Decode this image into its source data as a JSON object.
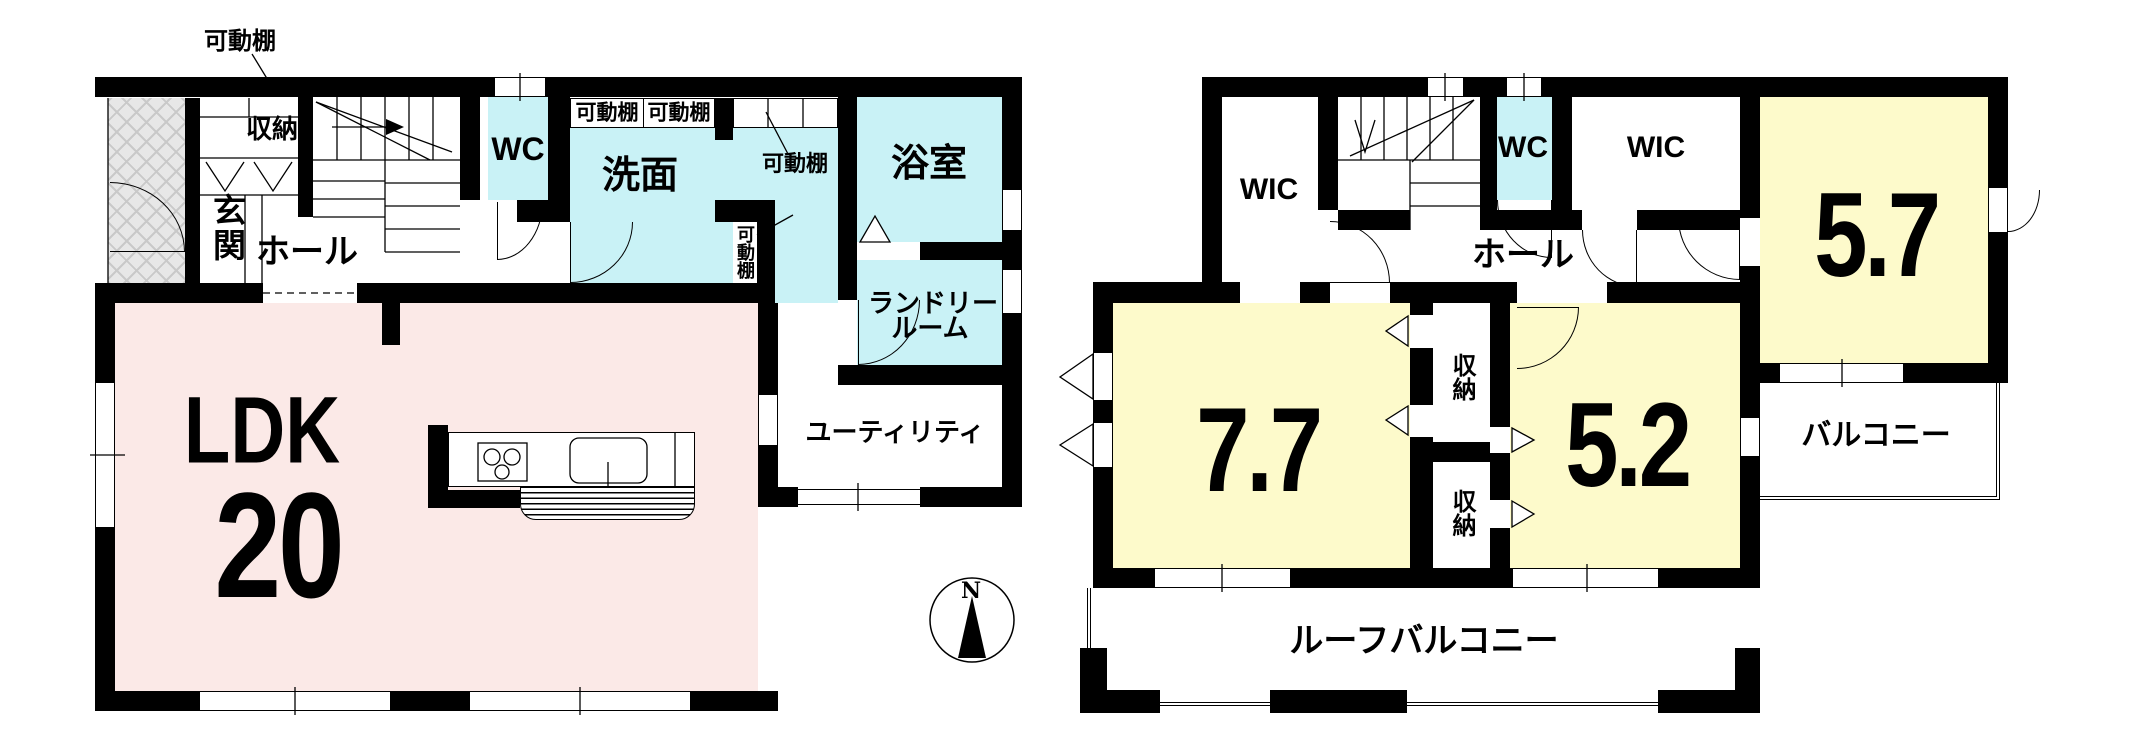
{
  "document_type": "floor-plan",
  "colors": {
    "wall": "#000000",
    "ldk_pink": "#fbe9e7",
    "wet_area_blue": "#c9f2f6",
    "room_yellow": "#fdfacb",
    "porch_gray": "#e7e7e7"
  },
  "compass": {
    "north_label": "N"
  },
  "floor1": {
    "labels": {
      "shelf_top_callout": "可動棚",
      "storage": "収納",
      "entrance": "玄関",
      "hall": "ホール",
      "wc": "WC",
      "shelf_box_left": "可動棚",
      "shelf_box_right": "可動棚",
      "washroom": "洗面",
      "shelf_callout_right": "可動棚",
      "shelf_niche": "可動棚",
      "bathroom": "浴室",
      "laundry_line1": "ランドリー",
      "laundry_line2": "ルーム",
      "utility": "ユーティリティ",
      "ldk": "LDK",
      "ldk_size": "20"
    }
  },
  "floor2": {
    "labels": {
      "wic_left": "WIC",
      "wc": "WC",
      "wic_right": "WIC",
      "hall": "ホール",
      "room_5_7": "5.7",
      "room_7_7": "7.7",
      "room_5_2": "5.2",
      "storage_upper": "収納",
      "storage_lower": "収納",
      "balcony": "バルコニー",
      "roof_balcony": "ルーフバルコニー"
    }
  }
}
